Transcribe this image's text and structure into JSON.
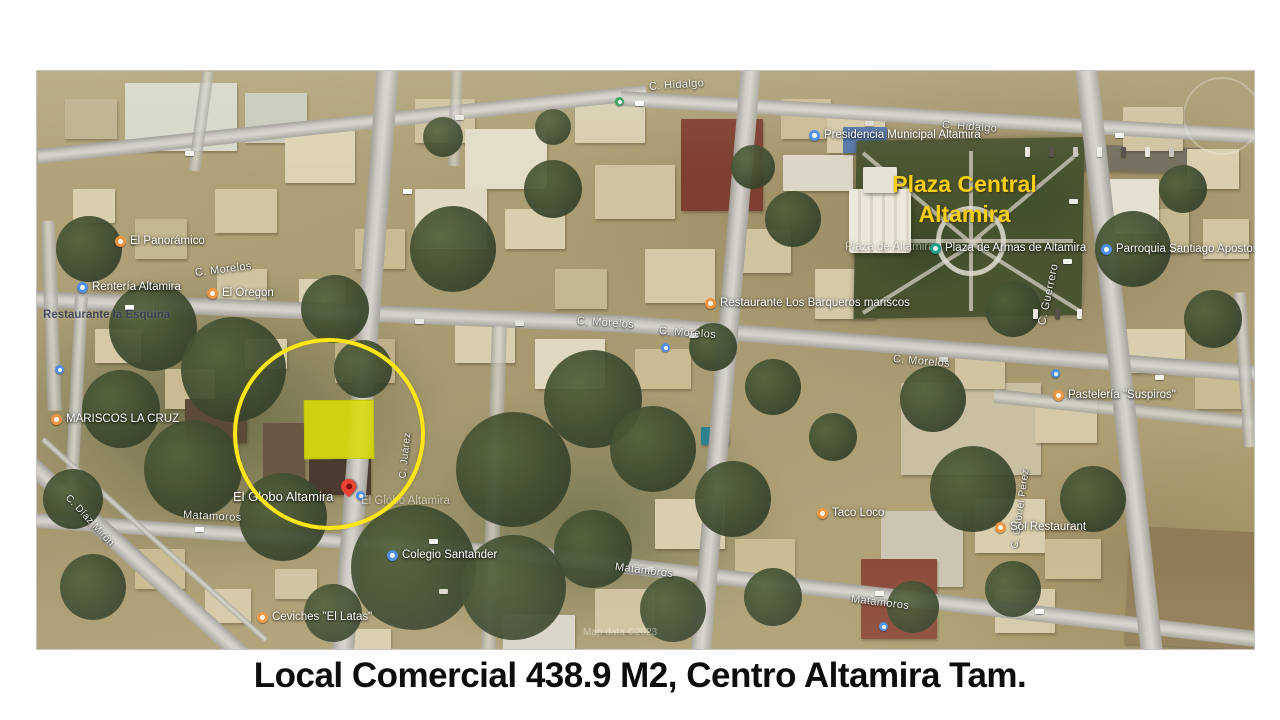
{
  "caption": "Local Comercial 438.9 M2, Centro Altamira Tam.",
  "map": {
    "headline": {
      "line1": "Plaza Central",
      "line2": "Altamira",
      "color": "#F5CE15"
    },
    "highlight": {
      "circle_color": "#FFE619",
      "parcel_color": "#D8DC08",
      "pin_color": "#EA4335"
    },
    "watermark": "Map data ©2023",
    "streets": [
      {
        "text": "C. Hidalgo"
      },
      {
        "text": "C. Hidalgo"
      },
      {
        "text": "C. Morelos"
      },
      {
        "text": "C. Morelos"
      },
      {
        "text": "C. Morelos"
      },
      {
        "text": "C. Morelos"
      },
      {
        "text": "C. Juárez"
      },
      {
        "text": "C. Guerrero"
      },
      {
        "text": "Matamoros"
      },
      {
        "text": "Matamoros"
      },
      {
        "text": "Matamoros"
      },
      {
        "text": "C. Díaz Mirón"
      },
      {
        "text": "C. Gabriel Pérez"
      }
    ],
    "pois": [
      {
        "text": "El Panorámico",
        "icon": "restaurant"
      },
      {
        "text": "Rentería Altamira",
        "icon": "place"
      },
      {
        "text": "El Oregon",
        "icon": "restaurant"
      },
      {
        "text": "Restaurante la Esquina",
        "icon": "none"
      },
      {
        "text": "MARISCOS LA CRUZ",
        "icon": "restaurant"
      },
      {
        "text": "El Globo Altamira",
        "icon": "red-pin"
      },
      {
        "text": "El Globo Altamira",
        "icon": "none"
      },
      {
        "text": "Colegio Santander",
        "icon": "place"
      },
      {
        "text": "Ceviches \"El Latas\"",
        "icon": "restaurant"
      },
      {
        "text": "Presidencia Municipal Altamira",
        "icon": "civic"
      },
      {
        "text": "Plaza de Altamira",
        "icon": "none"
      },
      {
        "text": "Plaza de Armas de Altamira",
        "icon": "park"
      },
      {
        "text": "Parroquia Santiago Apóstol",
        "icon": "church"
      },
      {
        "text": "Restaurante Los Barqueros mariscos",
        "icon": "restaurant"
      },
      {
        "text": "Pastelería \"Suspiros\"",
        "icon": "restaurant"
      },
      {
        "text": "Taco Loco",
        "icon": "restaurant"
      },
      {
        "text": "Sol Restaurant",
        "icon": "restaurant"
      }
    ]
  }
}
